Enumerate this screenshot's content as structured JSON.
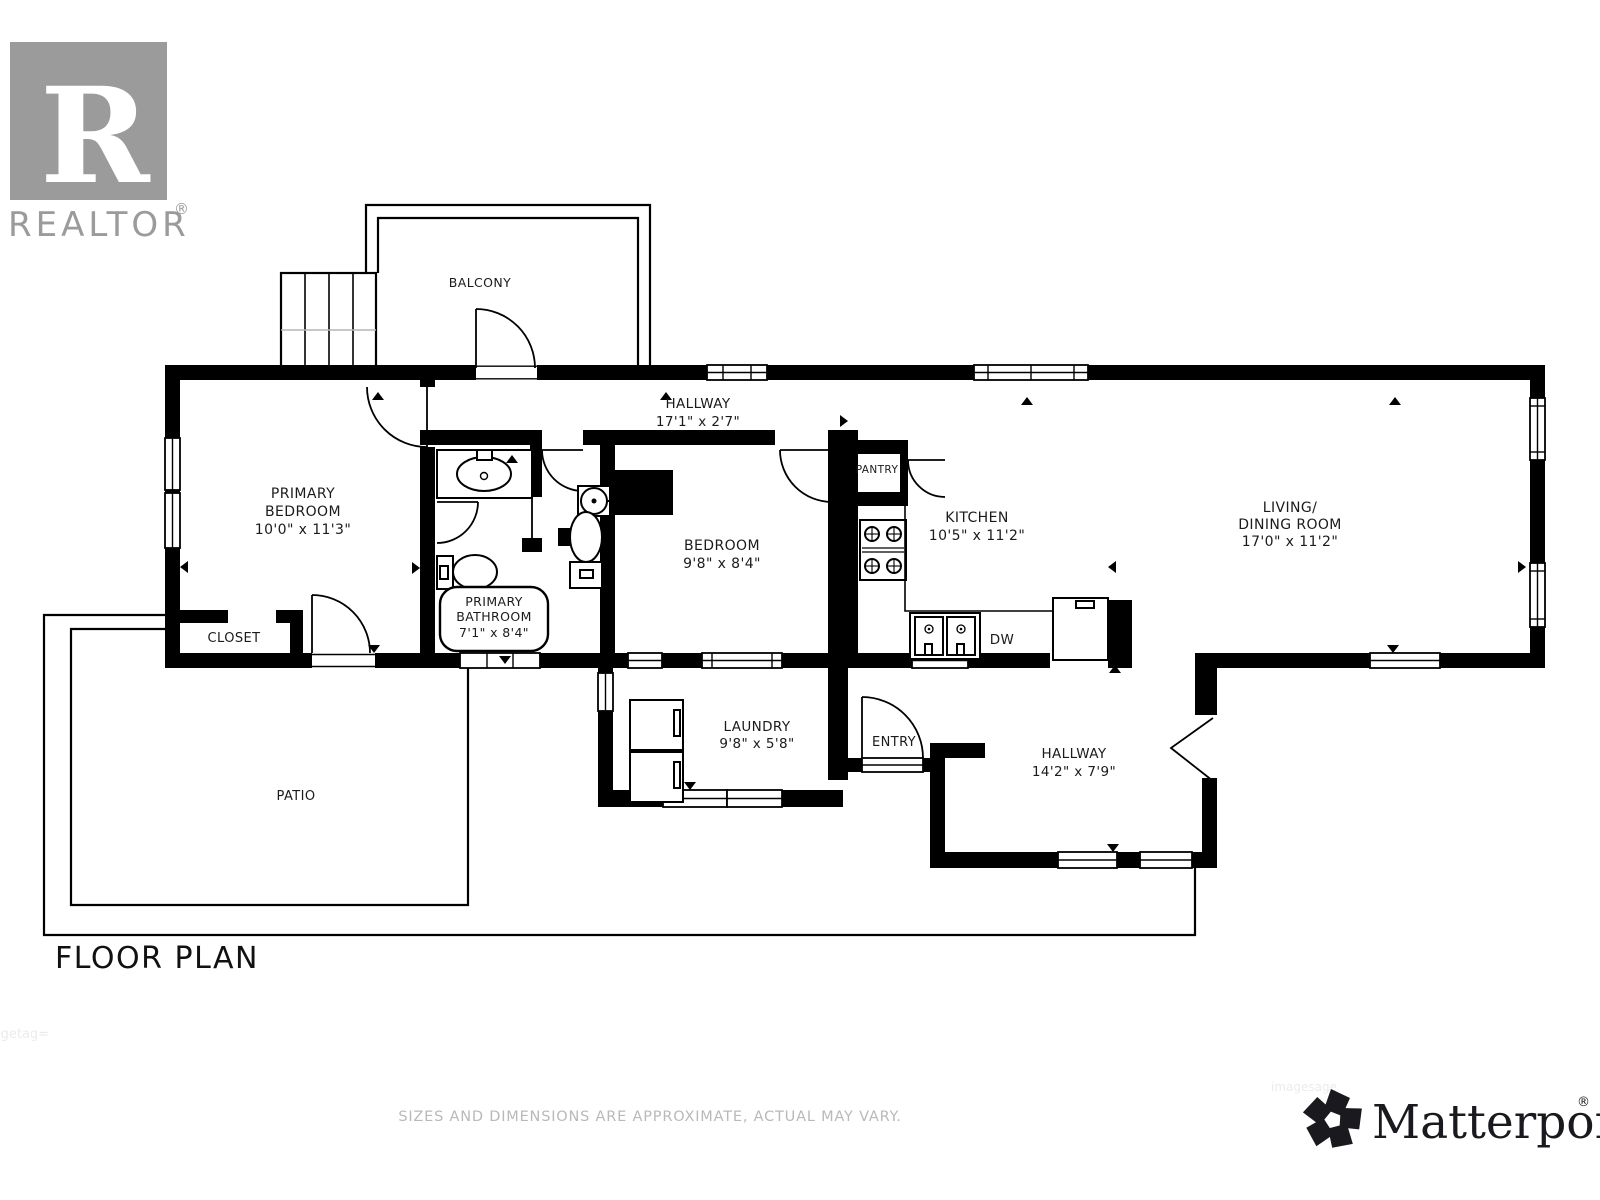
{
  "branding": {
    "realtor_letter": "R",
    "realtor_wordmark": "REALTOR",
    "realtor_reg": "®",
    "matterport_wordmark": "Matterport",
    "matterport_reg": "®"
  },
  "title": "FLOOR PLAN",
  "disclaimer": "SIZES AND DIMENSIONS ARE APPROXIMATE, ACTUAL MAY VARY.",
  "watermarks": {
    "left": "igetag=",
    "right": "imagesage"
  },
  "rooms": {
    "balcony": {
      "name": "BALCONY"
    },
    "hallway_top": {
      "name": "HALLWAY",
      "dims": "17'1\" x 2'7\""
    },
    "primary_bedroom": {
      "name_line1": "PRIMARY",
      "name_line2": "BEDROOM",
      "dims": "10'0\" x 11'3\""
    },
    "primary_bathroom": {
      "name_line1": "PRIMARY",
      "name_line2": "BATHROOM",
      "dims": "7'1\" x 8'4\""
    },
    "closet": {
      "name": "CLOSET"
    },
    "bedroom": {
      "name": "BEDROOM",
      "dims": "9'8\" x 8'4\""
    },
    "pantry": {
      "name": "PANTRY"
    },
    "kitchen": {
      "name": "KITCHEN",
      "dims": "10'5\" x 11'2\""
    },
    "living_dining": {
      "name_line1": "LIVING/",
      "name_line2": "DINING ROOM",
      "dims": "17'0\" x 11'2\""
    },
    "laundry": {
      "name": "LAUNDRY",
      "dims": "9'8\" x 5'8\""
    },
    "entry": {
      "name": "ENTRY"
    },
    "hallway_lower": {
      "name": "HALLWAY",
      "dims": "14'2\" x 7'9\""
    },
    "patio": {
      "name": "PATIO"
    },
    "appliances": {
      "dishwasher": "DW"
    }
  },
  "colors": {
    "walls": "#000000",
    "logo_gray": "#9b9b9b",
    "disclaimer_gray": "#b9b9bd",
    "matterport_black": "#1a1a1e"
  }
}
